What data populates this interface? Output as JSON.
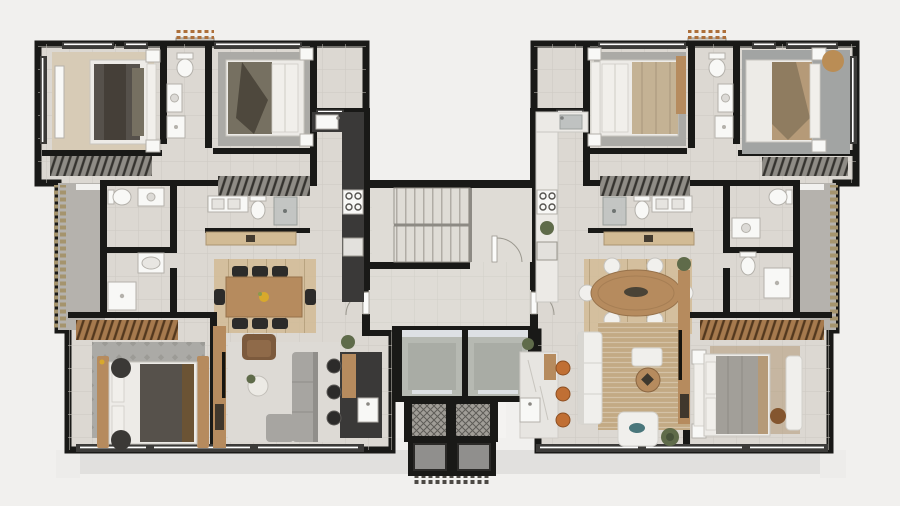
{
  "meta": {
    "kind": "architectural-floor-plan",
    "view": "top-down-3d-render",
    "units_on_floor": 2,
    "symmetry": "mirrored-about-central-core"
  },
  "palette": {
    "bg": "#f1f0ee",
    "ledge": "#e1e0de",
    "ledge2": "#edecea",
    "wall": "#191917",
    "floor": "#dcd8d2",
    "floorHall": "#dfdcd6",
    "grout": "#cdc9c2",
    "terrace": "#b5b2ad",
    "hedgeTan": "#a5946d",
    "combOrange": "#ad6f3a",
    "combDark": "#4c4944",
    "winFrame": "#3c3b39",
    "glassLine": "#ffffff",
    "wood": "#b68b5e",
    "woodLight": "#d2bb95",
    "woodDark": "#8a6642",
    "counterDark": "#3a3938",
    "counterLight": "#eceae6",
    "marble": "#e7e5e1",
    "steel": "#bfc2c1",
    "fixture": "#f8f8f6",
    "fixtureStroke": "#b4b1ab",
    "bedWhite": "#edebe7",
    "bedDark": "#56514b",
    "bedOlive": "#767061",
    "bedGray": "#a29f99",
    "bedTan": "#b59a78",
    "pillow": "#f1efeb",
    "rugBeige": "#d7cbb6",
    "rugGray": "#abaaa6",
    "rugGray2": "#a2a4a3",
    "rugPatternDot": "#8f8d89",
    "rugJute": "#c3aa84",
    "rugLight": "#dddad5",
    "sofaGray": "#a7a5a1",
    "sofaWhite": "#f0efec",
    "chairBlack": "#2c2b2a",
    "chairWhite": "#f1f0ed",
    "armBrown": "#7c5a3d",
    "stoolOrange": "#c06f34",
    "teal": "#49767b",
    "poufTan": "#ba8d55",
    "poufBrown": "#84562f",
    "plant": "#5f6b4a",
    "plantDark": "#47523a",
    "elevCab": "#b6b9b2",
    "elevCabIn": "#a9aca5",
    "elevFrame": "#dde0e4",
    "duct": "#a09d97",
    "ductLine": "#5e5c57",
    "shaftGray": "#908f8d",
    "hatchGray": "#8f8c86",
    "hatchLine": "#35332f",
    "hatchWood": "#a67a4e",
    "hatchWoodLine": "#53381e",
    "stairTread": "#b0aca5",
    "accentYellow": "#d8a92c",
    "doorWhite": "#fbfbfa"
  },
  "plan": {
    "core": {
      "rooms": [
        "stair-hall",
        "elevator-lobby"
      ],
      "elements": [
        "staircase-double-flight",
        "stair-door",
        "elevator-1",
        "elevator-2",
        "service-shaft-1",
        "service-shaft-2",
        "duct-1",
        "duct-2",
        "entry-hedge"
      ]
    },
    "left_unit": {
      "rooms": [
        {
          "name": "bedroom-top-left",
          "furniture": [
            "double-bed-dark-blanket",
            "headboard",
            "nightstand",
            "nightstand",
            "wall-dresser",
            "beige-rug",
            "wardrobe-hatch"
          ]
        },
        {
          "name": "ensuite-bathroom",
          "furniture": [
            "toilet",
            "washbasin",
            "shower"
          ]
        },
        {
          "name": "bedroom-second",
          "furniture": [
            "double-bed-olive-blanket",
            "headboard",
            "nightstand",
            "nightstand",
            "gray-rug",
            "wardrobe-hatch"
          ]
        },
        {
          "name": "kitchen-dark",
          "furniture": [
            "counter",
            "sink",
            "gas-cooktop",
            "appliance",
            "island",
            "bar-stool",
            "bar-stool",
            "bar-stool",
            "island-sink"
          ]
        },
        {
          "name": "family-bathroom",
          "furniture": [
            "double-washbasin",
            "toilet",
            "shower-box"
          ]
        },
        {
          "name": "lavatory",
          "furniture": [
            "toilet",
            "washbasin"
          ]
        },
        {
          "name": "service-bathroom",
          "furniture": [
            "washbasin",
            "shower"
          ]
        },
        {
          "name": "terrace",
          "furniture": [
            "hedge"
          ]
        },
        {
          "name": "living-dining",
          "furniture": [
            "dining-table-rect",
            "chair-x8-black",
            "flower-centerpiece",
            "armchair-brown",
            "sofa-l-gray",
            "coffee-table",
            "plant",
            "tv-panel",
            "wood-console",
            "light-rug"
          ]
        },
        {
          "name": "master-bedroom-bottom-left",
          "furniture": [
            "double-bed-dark-blanket",
            "wood-bench-rail",
            "wood-bench-rail",
            "ottoman",
            "ottoman",
            "patterned-rug",
            "wardrobe-hatch-wood"
          ]
        }
      ]
    },
    "right_unit": {
      "rooms": [
        {
          "name": "kitchen-light",
          "furniture": [
            "counter",
            "sink",
            "gas-cooktop",
            "plant",
            "appliance",
            "island-marble",
            "stool-orange",
            "stool-orange",
            "stool-orange",
            "island-sink"
          ]
        },
        {
          "name": "bedroom-second",
          "furniture": [
            "double-bed-striped-blanket",
            "headboard",
            "nightstand",
            "nightstand",
            "gray-rug",
            "side-dresser",
            "wardrobe-hatch"
          ]
        },
        {
          "name": "ensuite-bathroom",
          "furniture": [
            "toilet",
            "washbasin",
            "shower"
          ]
        },
        {
          "name": "master-bedroom-top-right",
          "furniture": [
            "double-bed-tan-blanket",
            "headboard",
            "nightstand",
            "nightstand",
            "round-pouf",
            "gray-rug",
            "wardrobe-hatch"
          ]
        },
        {
          "name": "family-bathroom",
          "furniture": [
            "double-washbasin",
            "toilet",
            "shower-box"
          ]
        },
        {
          "name": "lavatory",
          "furniture": [
            "toilet",
            "shower"
          ]
        },
        {
          "name": "terrace",
          "furniture": [
            "hedge"
          ]
        },
        {
          "name": "living-dining",
          "furniture": [
            "dining-table-oval",
            "chair-x6-white",
            "white-sofa",
            "white-armchair-teal-pillow",
            "white-ottoman",
            "coffee-table-wood",
            "plant",
            "plant",
            "tv-panel",
            "wood-console",
            "jute-rug"
          ]
        },
        {
          "name": "bedroom-bottom-right",
          "furniture": [
            "double-bed-gray-blanket",
            "headboard",
            "nightstand",
            "nightstand",
            "white-bench",
            "round-pouf-brown",
            "tan-rug",
            "wardrobe-hatch-wood"
          ]
        }
      ]
    },
    "exterior": [
      "bottom-eave-ledge",
      "corner-step-left",
      "corner-step-right",
      "ac-ledge-left",
      "ac-ledge-right",
      "terrace-hedge-left",
      "terrace-hedge-right"
    ]
  }
}
